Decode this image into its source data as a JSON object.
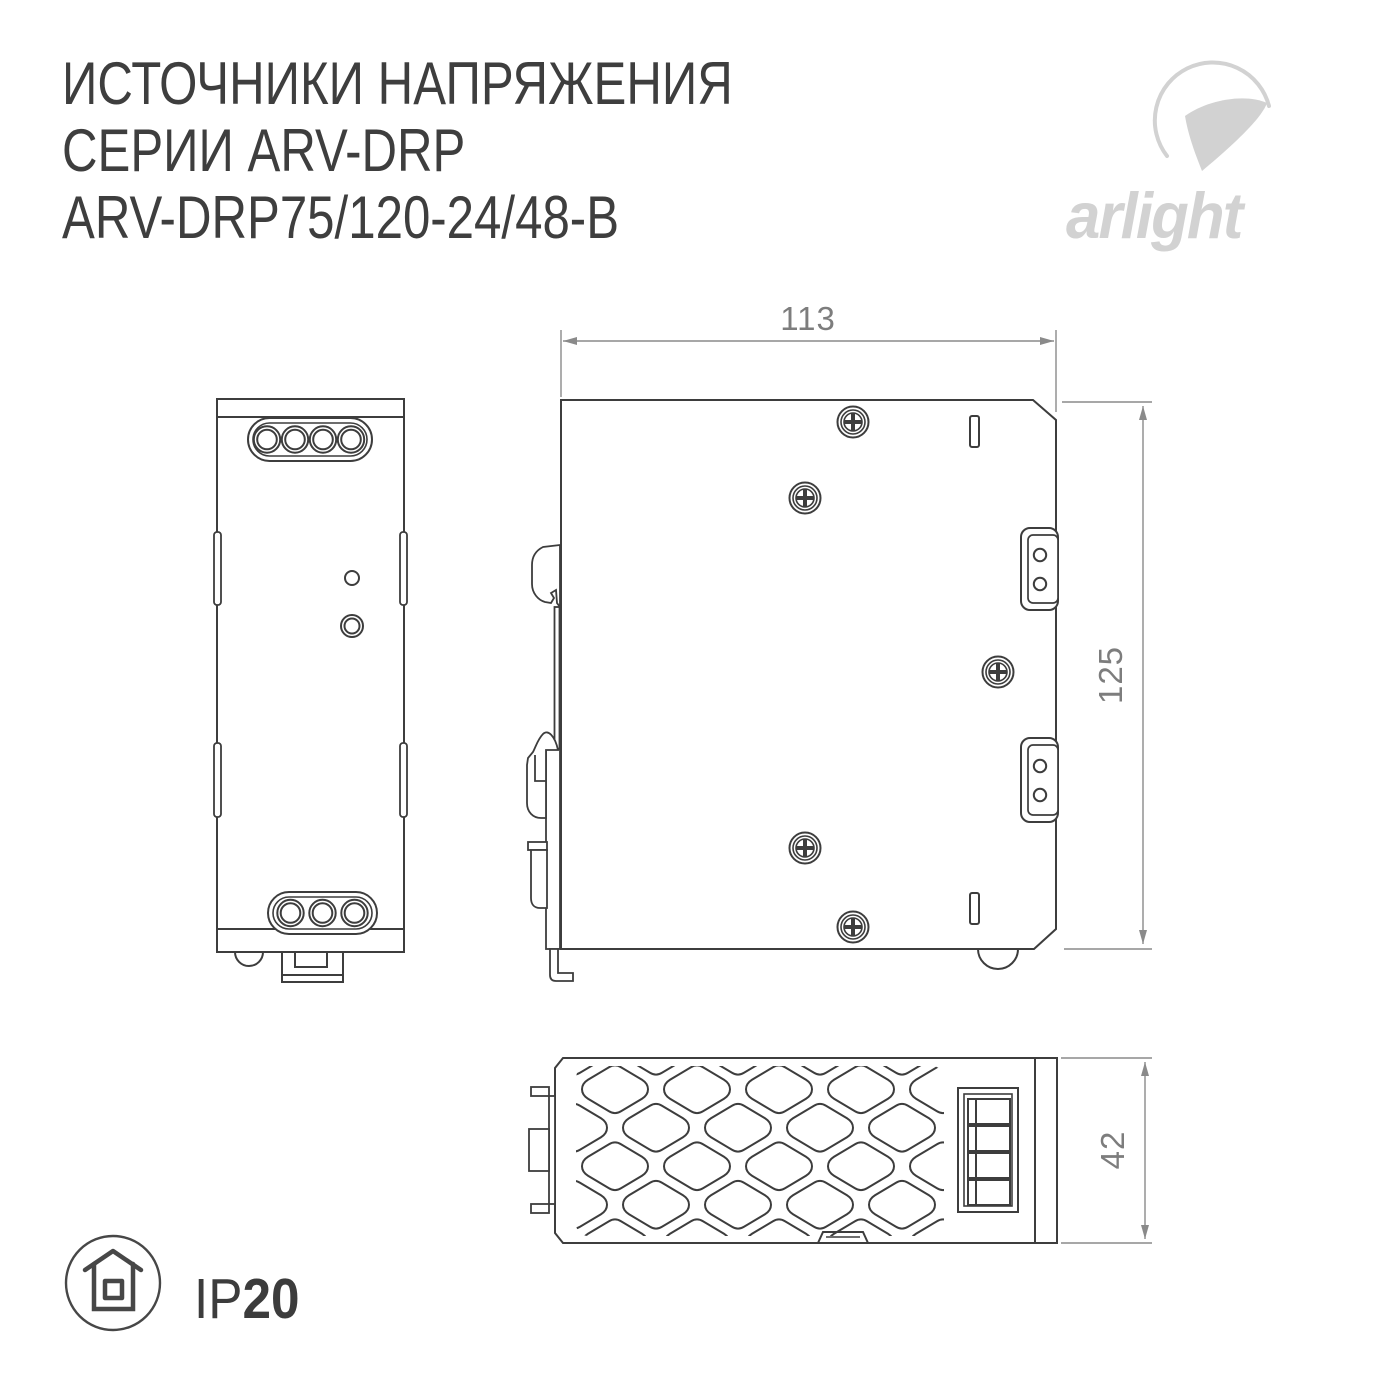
{
  "title": {
    "line1": "ИСТОЧНИКИ НАПРЯЖЕНИЯ",
    "line2": "СЕРИИ ARV-DRP",
    "line3": "ARV-DRP75/120-24/48-B"
  },
  "logo": {
    "brand": "arlight"
  },
  "drawing": {
    "dimensions": {
      "width": "113",
      "height": "125",
      "depth": "42"
    }
  },
  "protection": {
    "prefix": "IP",
    "value": "20"
  },
  "colors": {
    "line": "#3d3d3d",
    "dimension_line": "#8a8a8a",
    "dimension_text": "#7d7d7d",
    "title_text": "#3e3e3e",
    "logo_gray": "#d2d2d2"
  },
  "icons": {
    "brand": "arlight-swoosh-icon",
    "protection": "house-in-circle-icon"
  }
}
